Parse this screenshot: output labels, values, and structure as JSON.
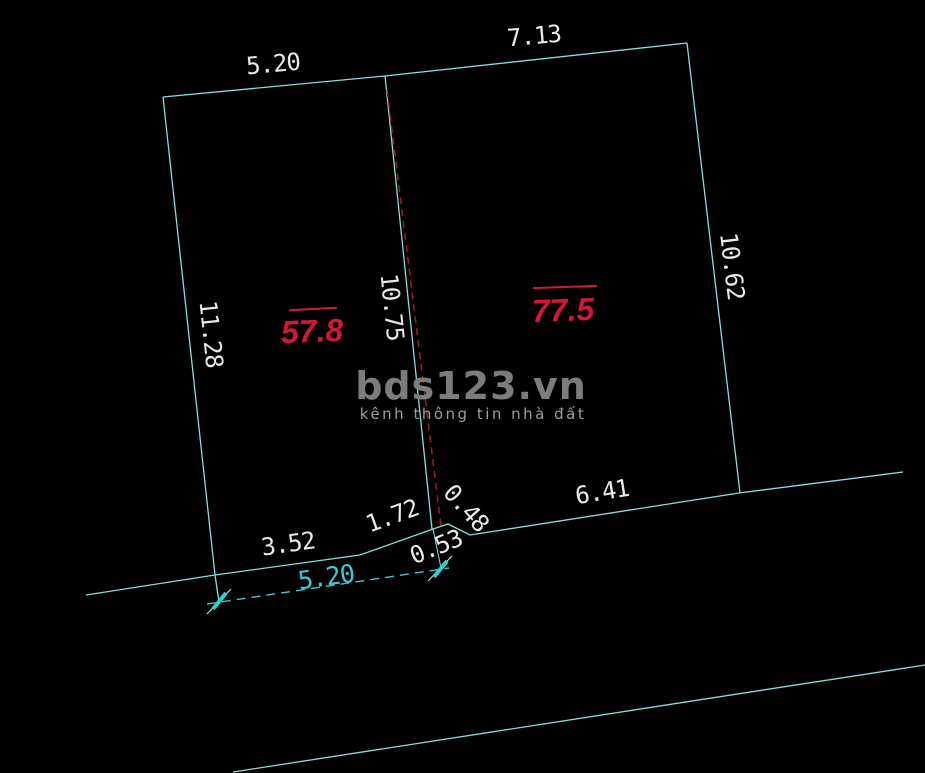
{
  "labels": {
    "top_left_width": "5.20",
    "top_right_width": "7.13",
    "left_side": "11.28",
    "divider": "10.75",
    "right_side": "10.62",
    "bottom_seg1": "3.52",
    "bottom_seg2": "1.72",
    "bottom_seg3": "0.48",
    "bottom_seg4": "0.53",
    "bottom_seg5": "6.41",
    "frontage_total": "5.20",
    "area_left": "57.8",
    "area_right": "77.5"
  },
  "watermark": {
    "brand": "bds123.vn",
    "tagline": "kênh thông tin nhà đất"
  },
  "colors": {
    "background": "#000000",
    "line_cyan": "#85dedb",
    "dim_text_white": "#e9e9e9",
    "area_red": "#d41735",
    "frontage_cyan": "#3cc9d8",
    "boundary_red_dash": "#a01c28",
    "watermark_gray": "#7c7c7c"
  }
}
